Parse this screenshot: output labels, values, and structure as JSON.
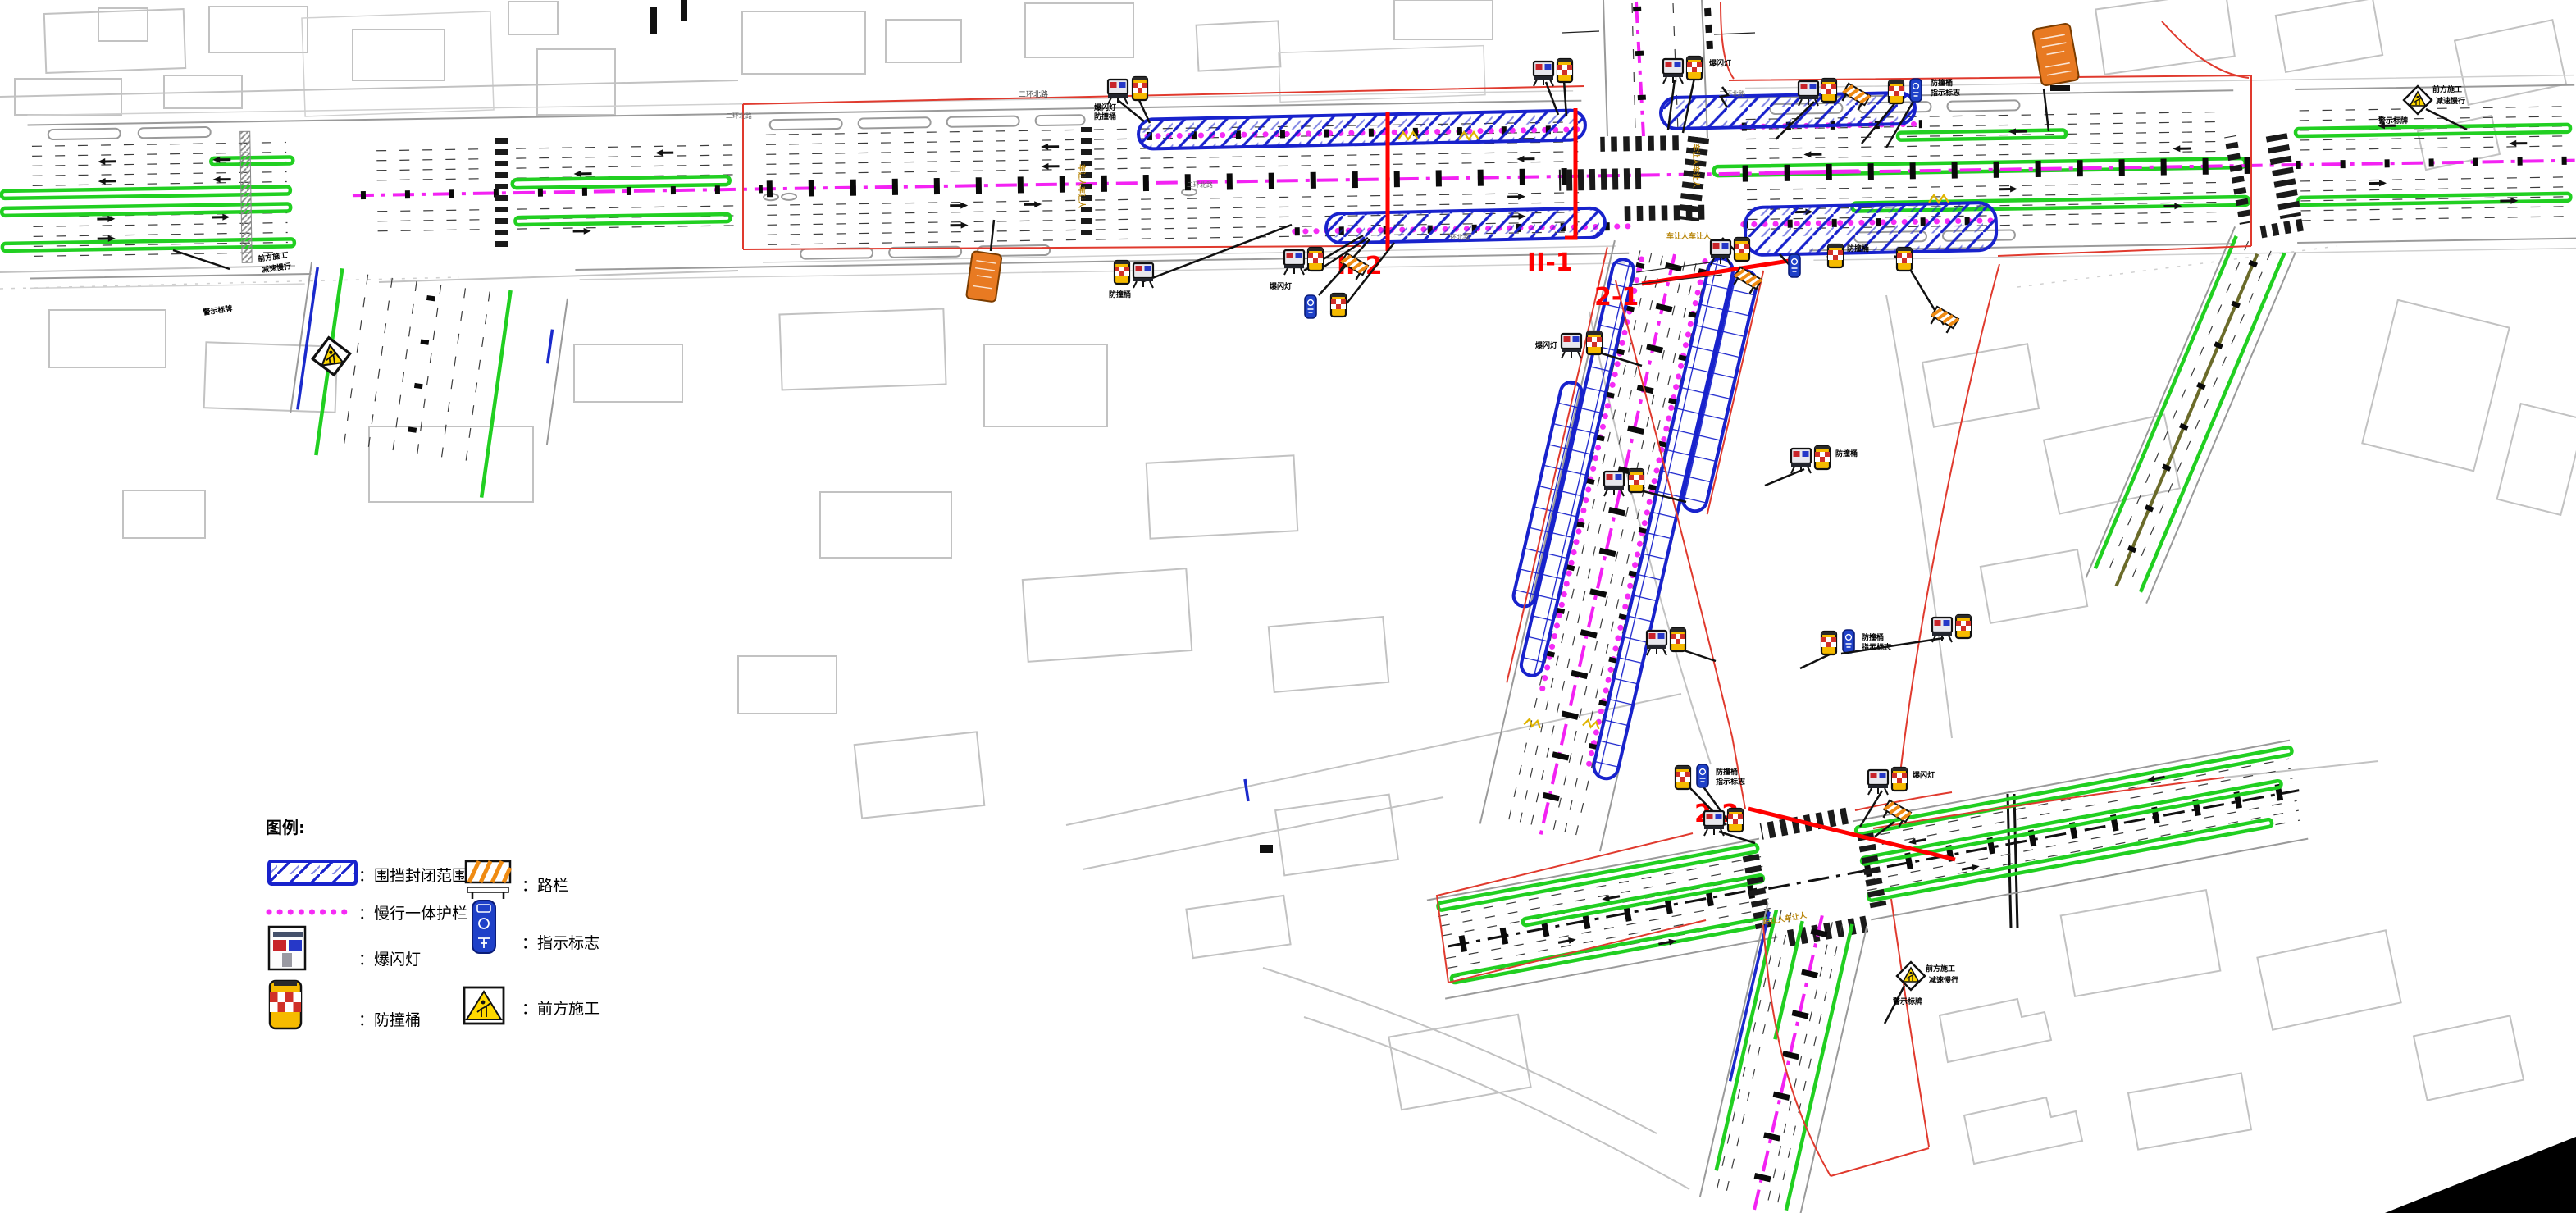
{
  "document": {
    "type": "construction-traffic-management-plan",
    "language": "zh-CN"
  },
  "legend": {
    "title": "图例:",
    "left_items": [
      {
        "id": "enclosure",
        "label": "：围挡封闭范围"
      },
      {
        "id": "guardrail",
        "label": "：慢行一体护栏"
      },
      {
        "id": "strobe",
        "label": "：爆闪灯"
      },
      {
        "id": "barrel",
        "label": "：防撞桶"
      }
    ],
    "right_items": [
      {
        "id": "barrier",
        "label": "：路栏"
      },
      {
        "id": "indication",
        "label": "：指示标志"
      },
      {
        "id": "ahead",
        "label": "：前方施工"
      }
    ]
  },
  "section_labels": {
    "II_2": "II-2",
    "II_1": "II-1",
    "s2_1": "2-1",
    "s2_2": "2-2"
  },
  "road_name": "二环北路",
  "crosswalk_caption": "车让人车让人",
  "sign_labels": {
    "strobe": "爆闪灯",
    "barrel": "防撞桶",
    "indication": "指示标志",
    "ahead": "前方施工",
    "slow": "减速慢行",
    "board": "警示标牌"
  },
  "colors": {
    "enclosure_blue": "#1822cc",
    "guardrail_magenta": "#f52bf5",
    "lane_green": "#21cf21",
    "boundary_red": "#e03a2e",
    "section_red": "#ff0000",
    "building_gray": "#c2c2c2",
    "barrier_orange": "#ef8b13",
    "warning_yellow": "#ffd800",
    "notice_orange": "#e87a22"
  }
}
